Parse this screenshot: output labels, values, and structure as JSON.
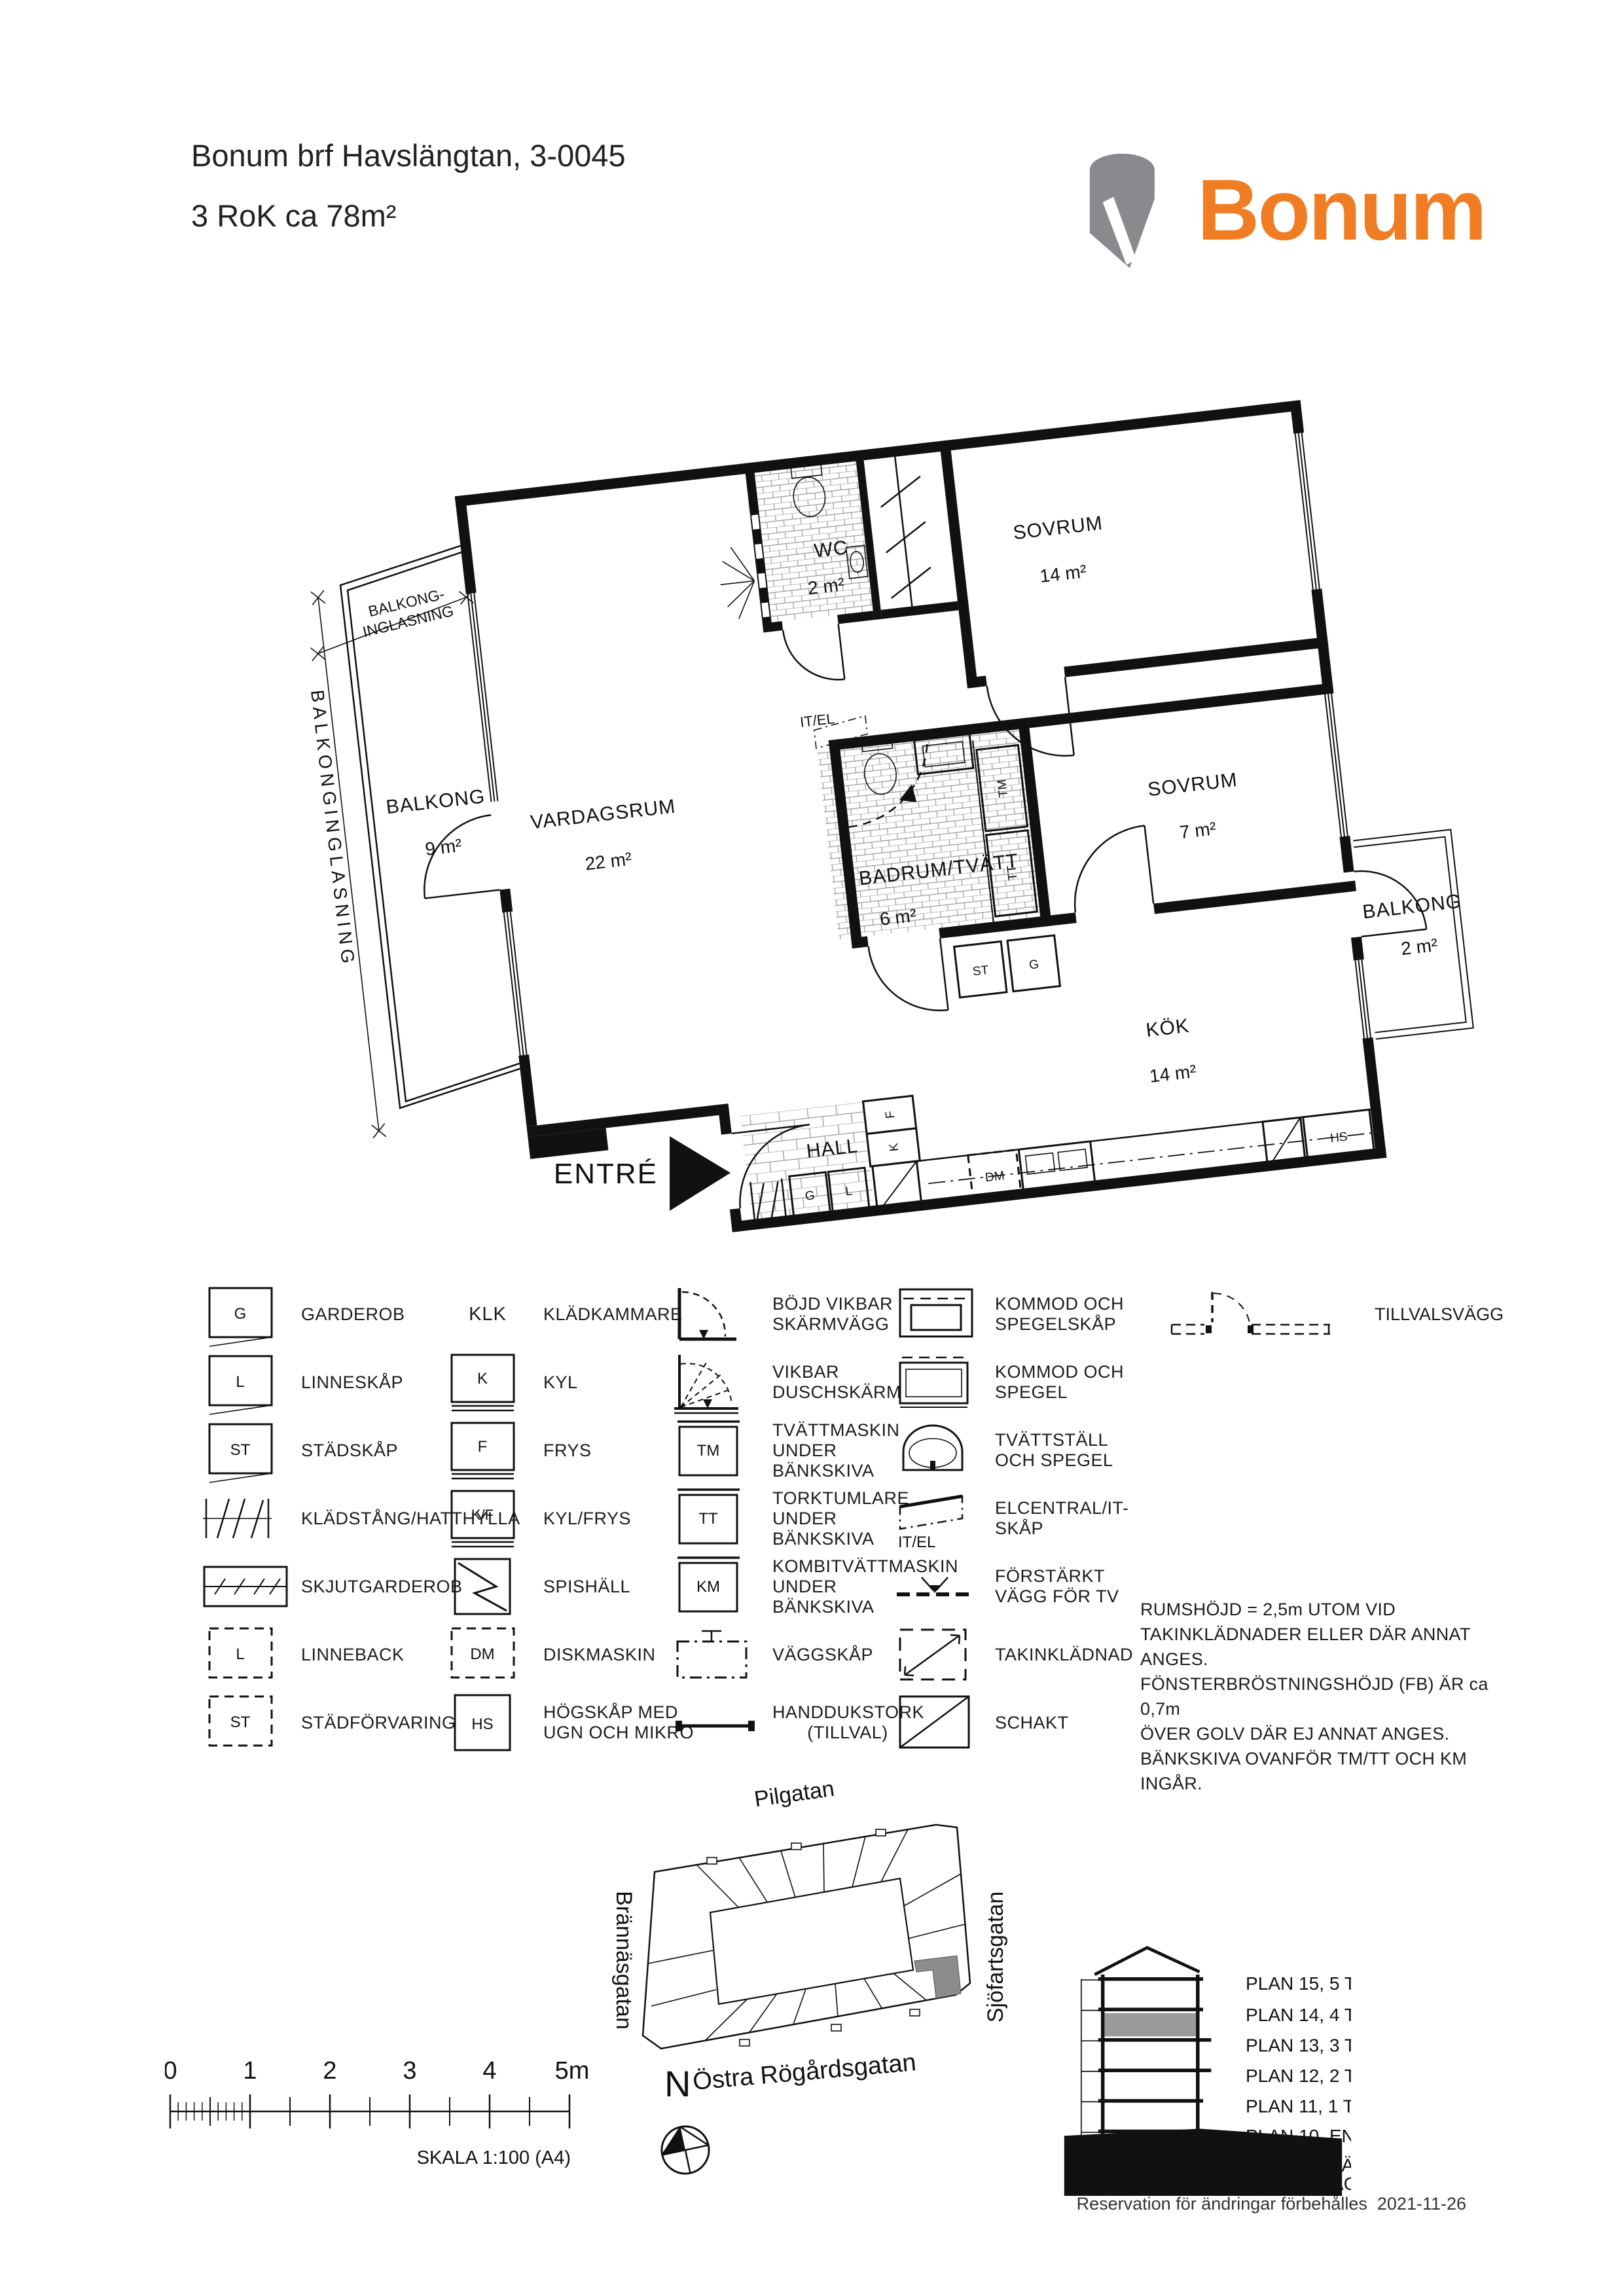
{
  "header": {
    "title_line1": "Bonum brf Havslängtan, 3-0045",
    "title_line2": "3 RoK ca 78m²",
    "logo_text": "Bonum",
    "logo_orange": "#F07D23",
    "logo_gray": "#8A8A8E"
  },
  "plan": {
    "rooms": {
      "sovrum1": {
        "name": "SOVRUM",
        "area": "14 m²"
      },
      "wc": {
        "name": "WC",
        "area": "2 m²"
      },
      "vardagsrum": {
        "name": "VARDAGSRUM",
        "area": "22 m²"
      },
      "balkong1": {
        "name": "BALKONG",
        "area": "9 m²"
      },
      "badrum": {
        "name": "BADRUM/TVÄTT",
        "area": "6 m²"
      },
      "sovrum2": {
        "name": "SOVRUM",
        "area": "7 m²"
      },
      "kok": {
        "name": "KÖK",
        "area": "14 m²"
      },
      "hall": {
        "name": "HALL"
      },
      "balkong2": {
        "name": "BALKONG",
        "area": "2 m²"
      }
    },
    "annotations": {
      "entre": "ENTRÉ",
      "inglasning_line1": "BALKONG-",
      "inglasning_line2": "INGLASNING",
      "inglasning_vertical": "BALKONGINGLASNING",
      "it_el": "IT/EL"
    },
    "codes": {
      "tm": "TM",
      "tt": "TT",
      "st": "ST",
      "g": "G",
      "l": "L",
      "k": "K",
      "f": "F",
      "dm": "DM",
      "hs": "HS"
    }
  },
  "legend": {
    "col1": [
      {
        "code": "G",
        "label": "GARDEROB"
      },
      {
        "code": "L",
        "label": "LINNESKÅP"
      },
      {
        "code": "ST",
        "label": "STÄDSKÅP"
      },
      {
        "label": "KLÄDSTÅNG/HATTHYLLA"
      },
      {
        "label": "SKJUTGARDEROB"
      },
      {
        "code": "L",
        "label": "LINNEBACK"
      },
      {
        "code": "ST",
        "label": "STÄDFÖRVARING"
      }
    ],
    "col2": [
      {
        "code": "KLK",
        "label": "KLÄDKAMMARE"
      },
      {
        "code": "K",
        "label": "KYL"
      },
      {
        "code": "F",
        "label": "FRYS"
      },
      {
        "code": "K/F",
        "label": "KYL/FRYS"
      },
      {
        "label": "SPISHÄLL"
      },
      {
        "code": "DM",
        "label": "DISKMASKIN"
      },
      {
        "code": "HS",
        "label": "HÖGSKÅP MED UGN OCH MIKRO"
      }
    ],
    "col3": [
      {
        "label": "BÖJD VIKBAR SKÄRMVÄGG"
      },
      {
        "label": "VIKBAR DUSCHSKÄRM"
      },
      {
        "code": "TM",
        "label": "TVÄTTMASKIN UNDER BÄNKSKIVA"
      },
      {
        "code": "TT",
        "label": "TORKTUMLARE UNDER BÄNKSKIVA"
      },
      {
        "code": "KM",
        "label": "KOMBITVÄTTMASKIN UNDER BÄNKSKIVA"
      },
      {
        "label": "VÄGGSKÅP"
      },
      {
        "label": "HANDDUKSTORK",
        "sublabel": "(TILLVAL)"
      }
    ],
    "col4": [
      {
        "label": "KOMMOD OCH SPEGELSKÅP"
      },
      {
        "label": "KOMMOD OCH SPEGEL"
      },
      {
        "label": "TVÄTTSTÄLL OCH SPEGEL"
      },
      {
        "code": "IT/EL",
        "label": "ELCENTRAL/IT-SKÅP"
      },
      {
        "label": "FÖRSTÄRKT VÄGG FÖR TV"
      },
      {
        "label": "TAKINKLÄDNAD"
      },
      {
        "label": "SCHAKT"
      }
    ],
    "tillval_label": "TILLVALSVÄGG"
  },
  "notes": [
    "RUMSHÖJD = 2,5m UTOM VID",
    "TAKINKLÄDNADER ELLER DÄR ANNAT ANGES.",
    "FÖNSTERBRÖSTNINGSHÖJD (FB) ÄR ca 0,7m",
    "ÖVER GOLV DÄR EJ ANNAT ANGES.",
    "BÄNKSKIVA OVANFÖR TM/TT OCH KM INGÅR."
  ],
  "site": {
    "streets": {
      "top": "Pilgatan",
      "left": "Brännäsgatan",
      "right": "Sjöfartsgatan",
      "bottom": "Östra Rögårdsgatan"
    },
    "north_label": "N",
    "highlight_color": "#8C8C8C"
  },
  "scalebar": {
    "ticks": [
      "0",
      "1",
      "2",
      "3",
      "4",
      "5m"
    ],
    "caption": "SKALA 1:100 (A4)"
  },
  "section": {
    "floors": [
      "PLAN 15, 5 TR",
      "PLAN 14, 4 TR",
      "PLAN 13, 3 TR",
      "PLAN 12, 2 TR",
      "PLAN 11, 1 TR",
      "PLAN 10, ENTRÉ",
      "PLAN 09, KÄLLARE",
      "OCH GARAGE"
    ],
    "highlighted_floor": "PLAN 14, 4 TR",
    "highlight_color": "#9A9A9A"
  },
  "footer": {
    "text": "Reservation för ändringar förbehålles",
    "date": "2021-11-26"
  }
}
